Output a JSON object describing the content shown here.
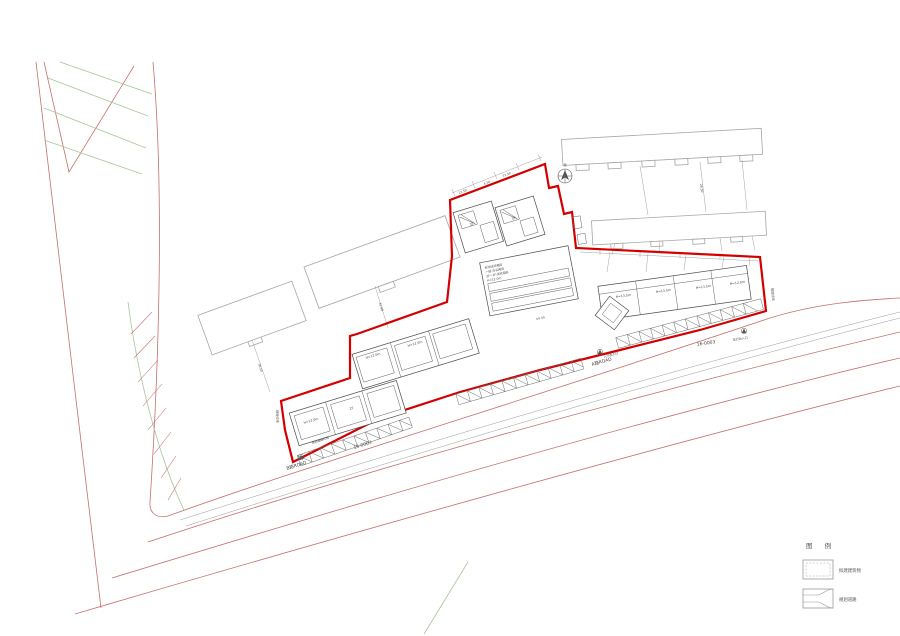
{
  "colors": {
    "site_boundary_red": "#d40000",
    "road_red": "#c4706b",
    "green_hatch": "#a8c69a",
    "existing_building_gray": "#a6a6a6",
    "new_building_line": "#4a4a4a"
  },
  "legend": {
    "title": "图 例",
    "items": [
      {
        "symbol": "proposed-building-symbol",
        "label": "拟建建筑物"
      },
      {
        "symbol": "planned-road-symbol",
        "label": "规划道路"
      }
    ]
  },
  "roads": {
    "a_road": "A路ROAD",
    "b_road": "B路ROAD",
    "parcel_left": "16-0003",
    "parcel_right": "16-0003"
  },
  "boundary_labels": {
    "planning_red_left": "规划红线",
    "planning_red_right": "规划红线",
    "road_red_line": "规划道路红线"
  },
  "entrances": {
    "vehicle": "车行出入口",
    "pedestrian": "人行出入口"
  },
  "north_label": "北",
  "building_labels": {
    "right_row": [
      "H=13.5m",
      "H=13.5m",
      "H=13.5m",
      "H=12.0m"
    ],
    "mid_row": [
      "H=12.0m",
      "H=12.0m"
    ],
    "bottom_row": [
      "H=12.0m",
      "2F"
    ],
    "top_squares": [
      "3F",
      "3F"
    ],
    "level": "±0.00",
    "center_block": [
      "检测试验用房",
      "一层:办公用房",
      "2F~3F:试验用房",
      "H=12.0m"
    ]
  },
  "dimensions": {
    "top": [
      "12.50",
      "4.20",
      "12.50"
    ],
    "left": [
      "41.88",
      "38.50",
      "26.50"
    ]
  }
}
